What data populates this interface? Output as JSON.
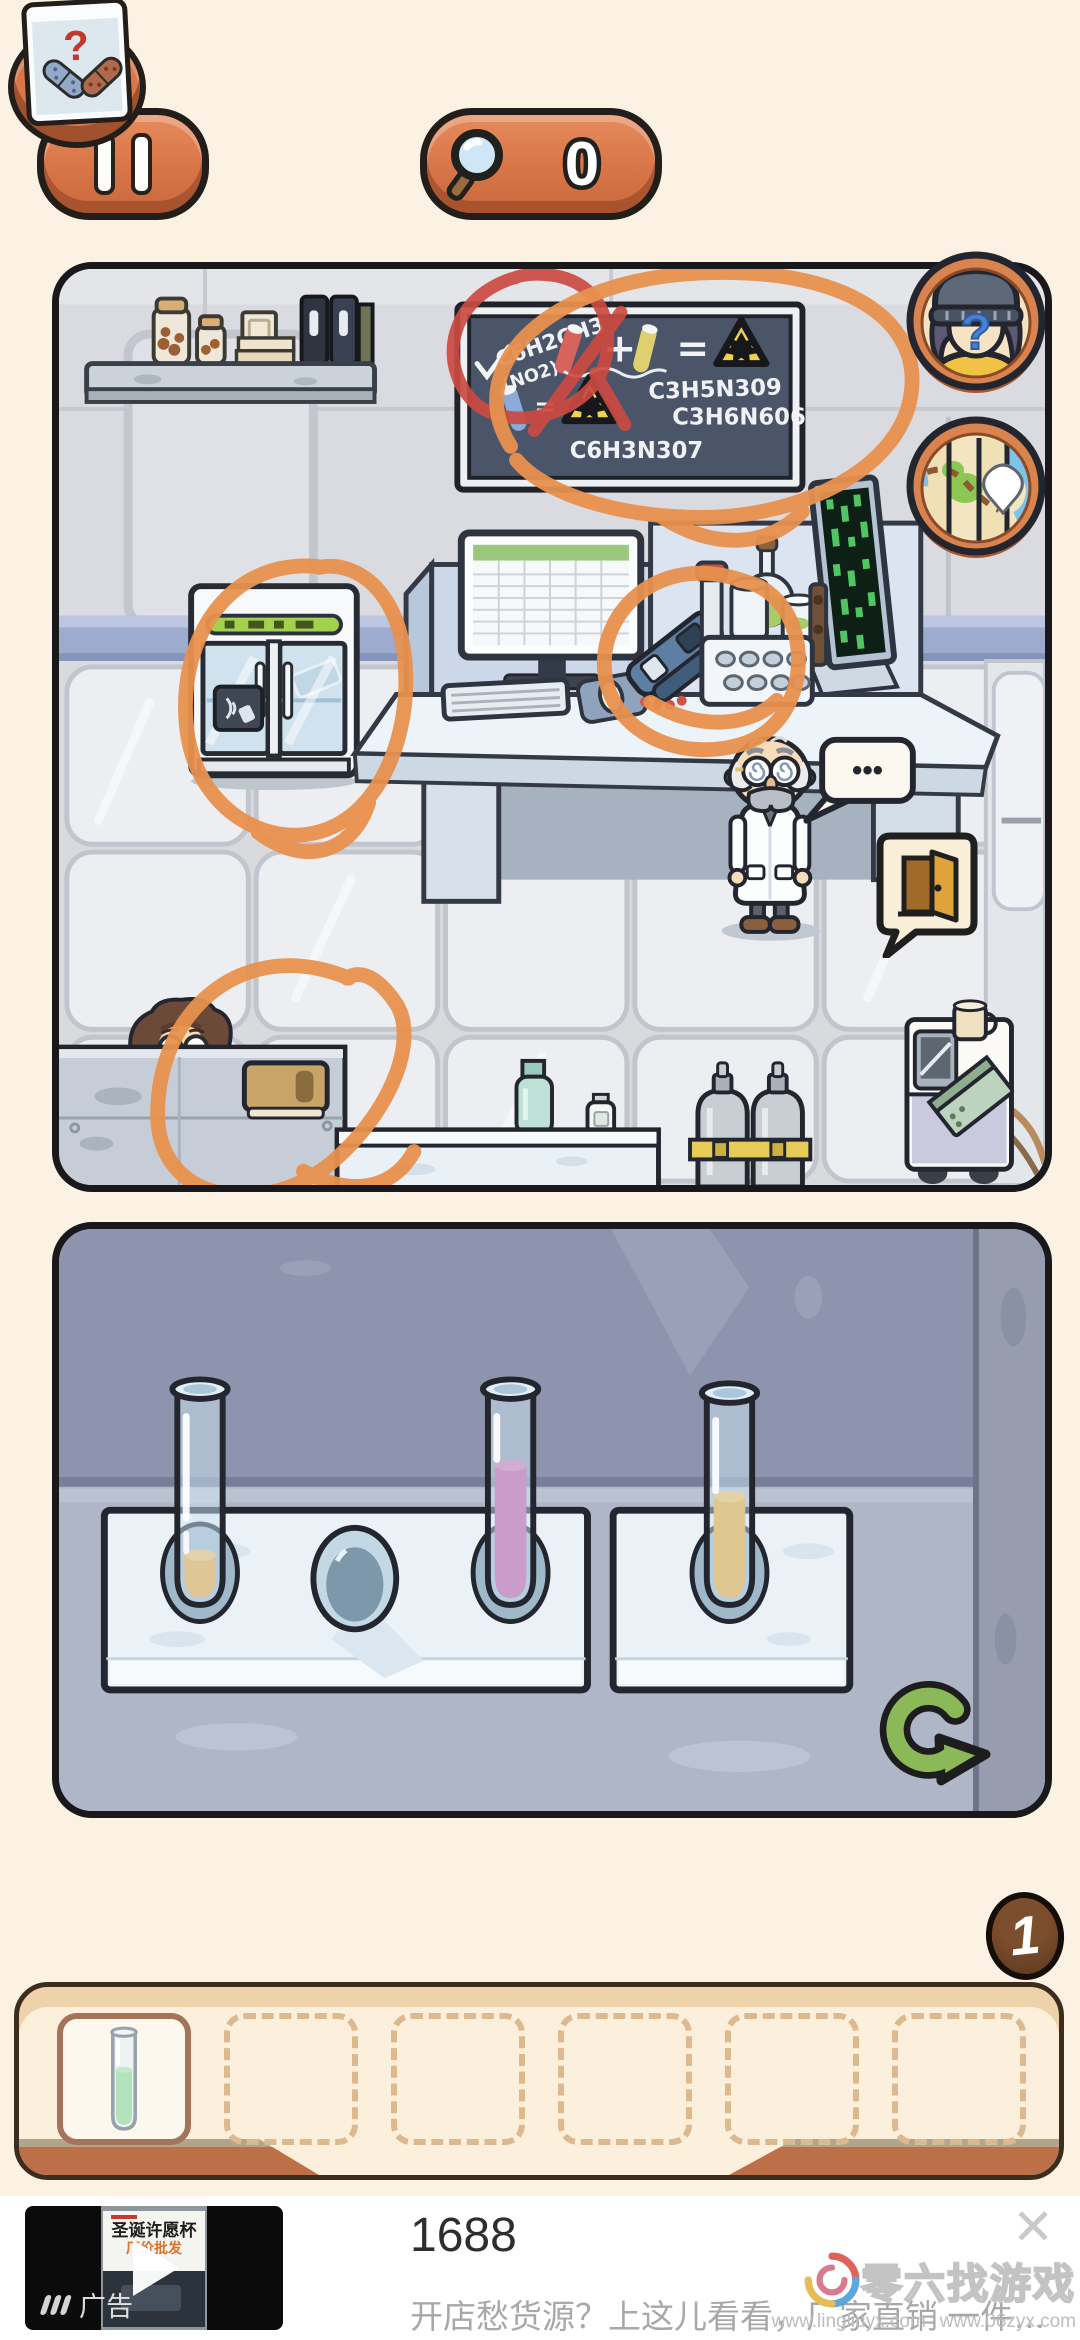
{
  "top_bar": {
    "search_count": "0",
    "clue_question_mark": "?"
  },
  "scene": {
    "chalkboard": {
      "formula_main": "C6H2CH3",
      "formula_main_sub": "(NO2)3",
      "plus_sign": "+",
      "equals_sign": "=",
      "equals_sign_2": "=",
      "formula_right_1": "C3H5N309",
      "formula_right_2": "C3H6N606",
      "formula_bottom": "C6H3N307"
    },
    "hint_question_mark": "?",
    "speech_dots": "•••",
    "annotations": {
      "color_orange": "#e8914e",
      "color_red": "#cb4a41",
      "circled_items": [
        "chalkboard",
        "lab-fridge",
        "desk-device",
        "lower-left-counter"
      ],
      "red_circled_item": "chalkboard-formula-C6H2CH3(NO2)3"
    }
  },
  "puzzle": {
    "tubes": [
      {
        "rack": "left",
        "slot": 1,
        "liquid_color": "#f2a63b",
        "fill_level": "low"
      },
      {
        "rack": "left",
        "slot": 3,
        "liquid_color": "#c4549e",
        "fill_level": "high"
      },
      {
        "rack": "right",
        "slot": 1,
        "liquid_color": "#f2aa2e",
        "fill_level": "medium"
      }
    ],
    "empty_slot": {
      "rack": "left",
      "slot": 2
    },
    "reset_color": "#8cb957"
  },
  "inventory": {
    "badge_count": "1",
    "slots": [
      {
        "item": "test-tube-green",
        "liquid_color": "#6fd065"
      },
      {
        "item": null
      },
      {
        "item": null
      },
      {
        "item": null
      },
      {
        "item": null
      },
      {
        "item": null
      }
    ]
  },
  "ad": {
    "label": "广告",
    "title": "1688",
    "subtitle": "开店愁货源？上这儿看看，厂家直销 一件…",
    "close": "✕",
    "thumb_title": "圣诞许愿杯",
    "thumb_subtitle": "厂价批发"
  },
  "watermark": {
    "brand": "零六找游戏",
    "url_1": "www.lingliuyx.com",
    "url_2": "www.06zyx.com"
  },
  "colors": {
    "button_orange": "#d97749",
    "background_cream": "#fbf2e3",
    "liquid_orange": "#f2a63b",
    "liquid_magenta": "#c4549e",
    "liquid_green": "#6fd065"
  }
}
